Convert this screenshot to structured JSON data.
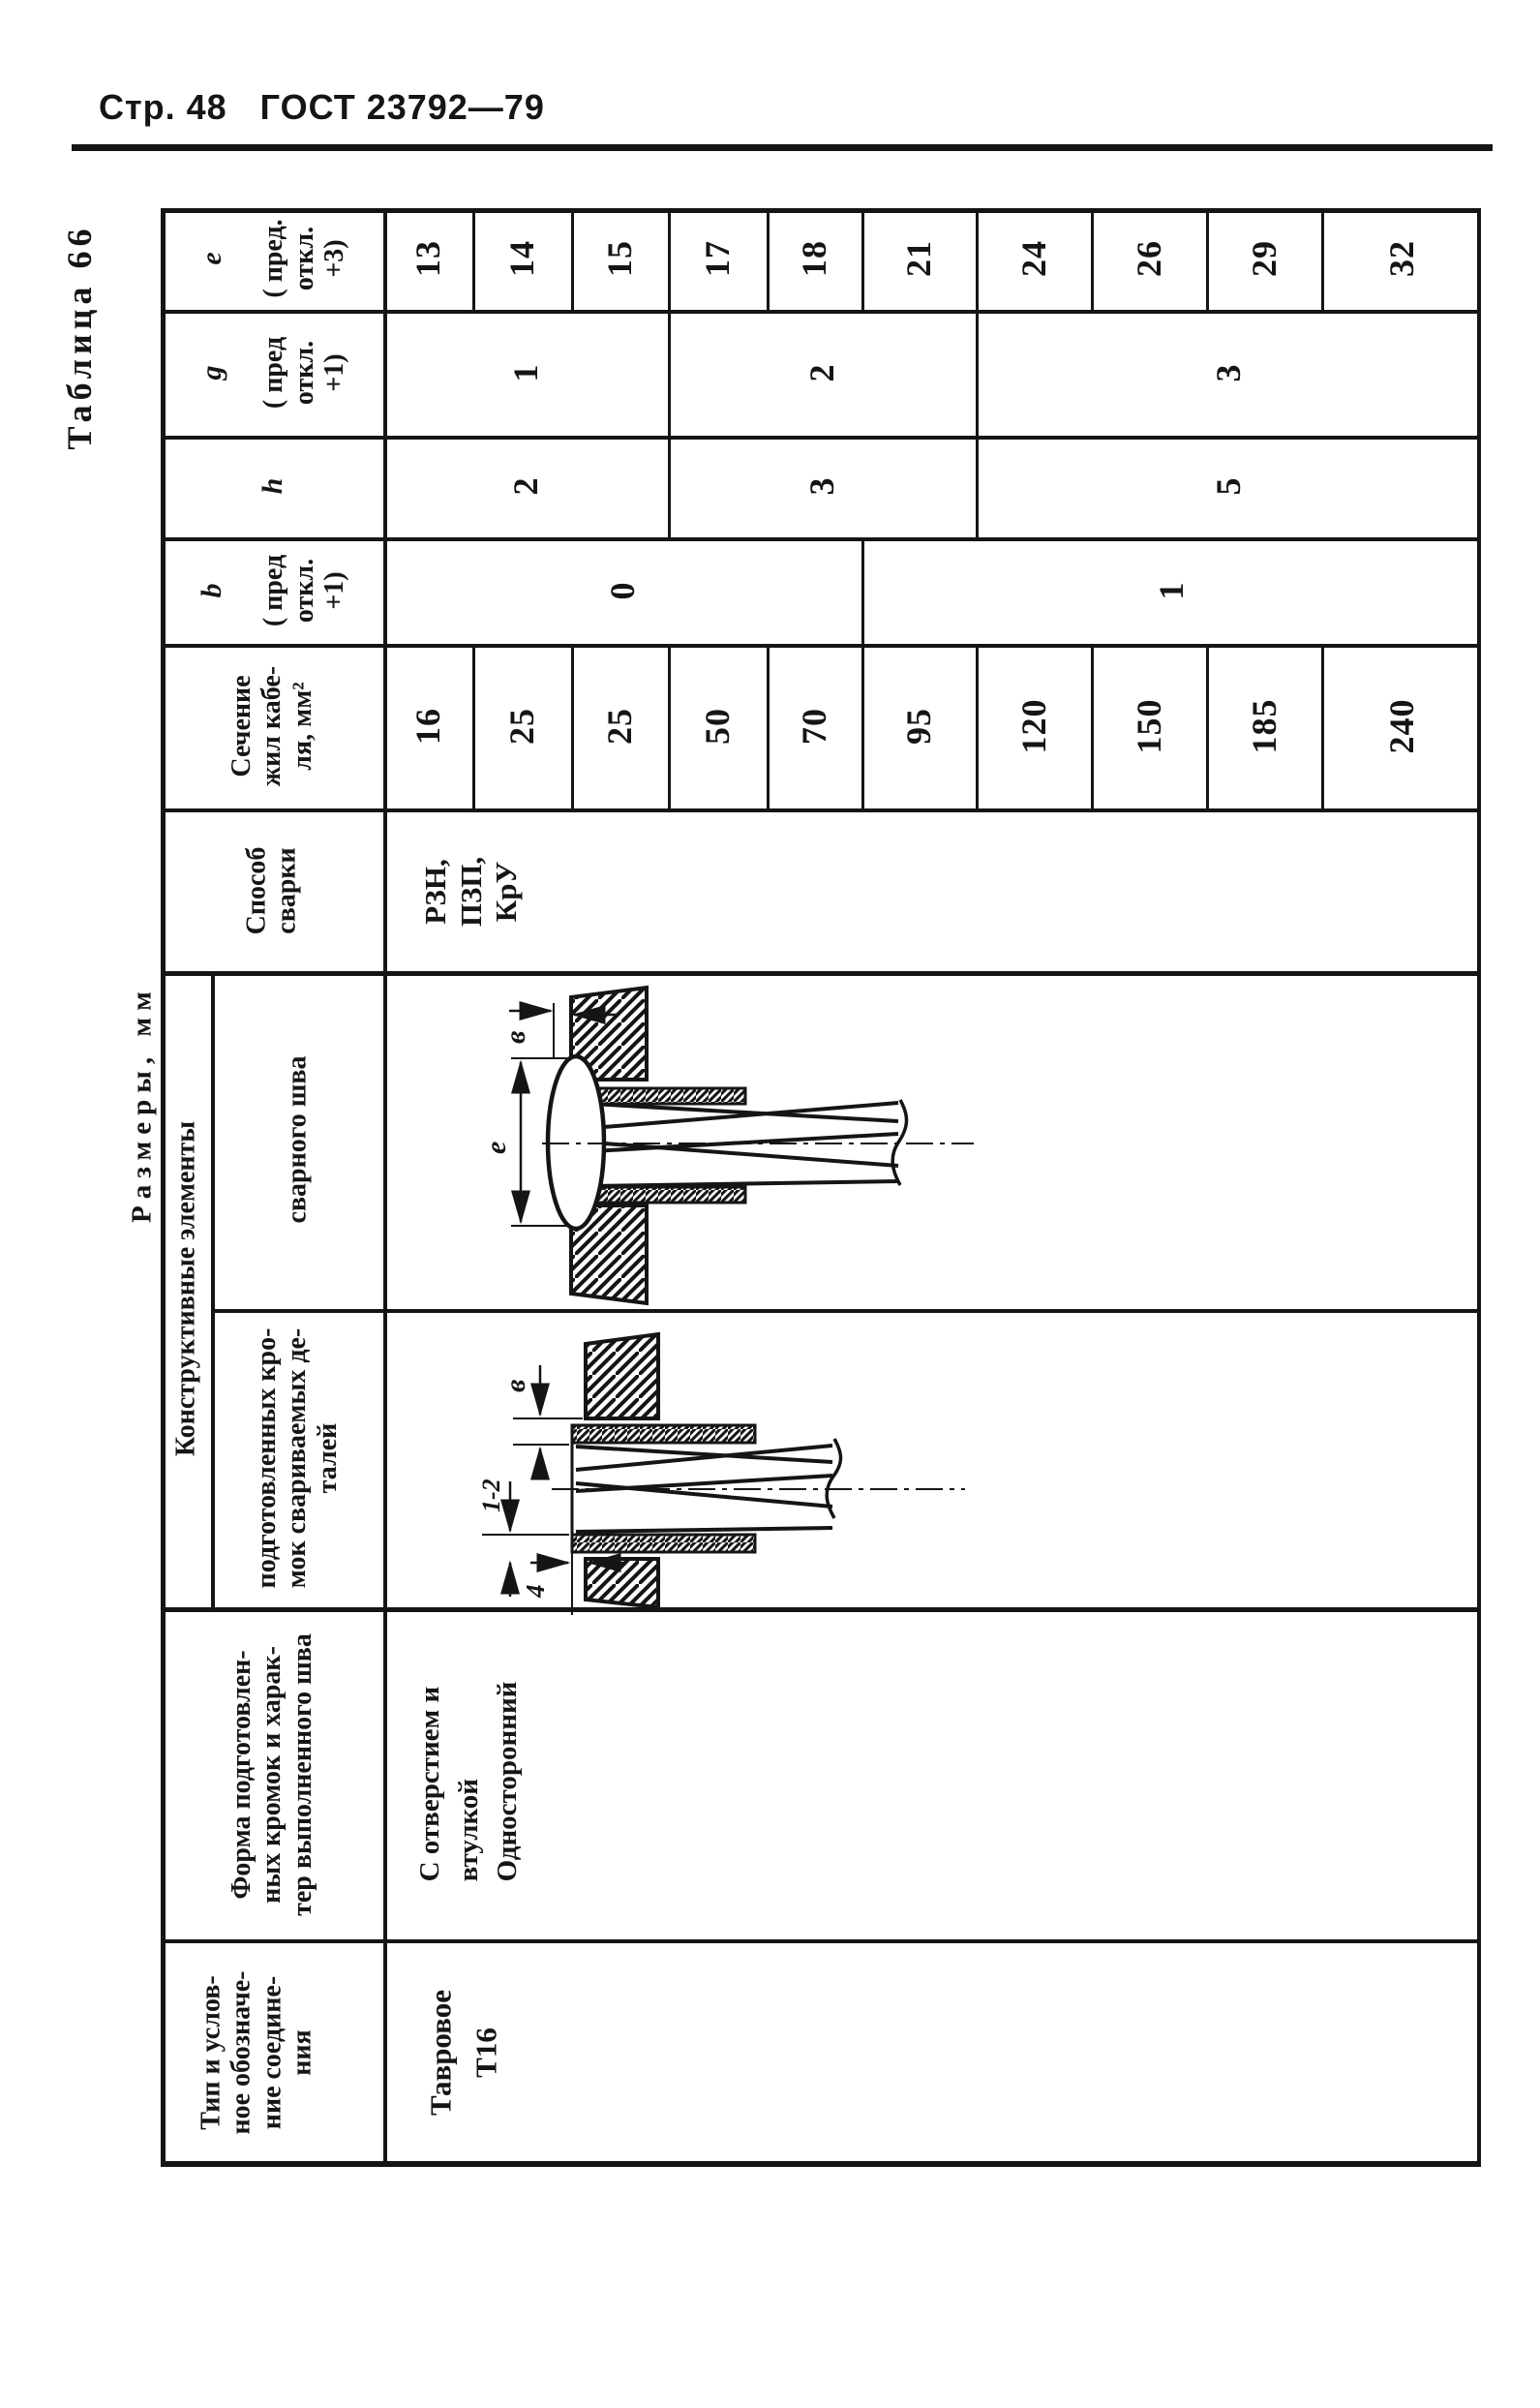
{
  "page": {
    "header_left": "Стр. 48",
    "header_right": "ГОСТ 23792—79",
    "table_caption": "Таблица 66",
    "units_note": "Размеры, мм",
    "ink_color": "#151515",
    "paper_color": "#ffffff"
  },
  "table": {
    "headers": {
      "type": [
        "Тип и услов-",
        "ное обозначе-",
        "ние соедине-",
        "ния"
      ],
      "form": [
        "Форма подготовлен-",
        "ных кромок и харак-",
        "тер выполненного шва"
      ],
      "constructive_group": "Конструктивные элементы",
      "sub_edges": [
        "подготовленных кро-",
        "мок свариваемых де-",
        "талей"
      ],
      "sub_weld": "сварного шва",
      "method": [
        "Способ",
        "сварки"
      ],
      "section": [
        "Сечение",
        "жил кабе-",
        "ля, мм²"
      ],
      "b_letter": "b",
      "b_tol": [
        "( пред",
        "откл.",
        "+1)"
      ],
      "h_letter": "h",
      "g_letter": "g",
      "g_tol": [
        "( пред",
        "откл.",
        "+1)"
      ],
      "e_letter": "е",
      "e_tol": [
        "( пред.",
        "откл.",
        "+3)"
      ]
    },
    "values": {
      "type": [
        "Тавровое",
        "Т16"
      ],
      "form": [
        "С отверстием и",
        "втулкой",
        "Односторонний"
      ],
      "method": [
        "РЗН,",
        "ПЗП,",
        "КрУ"
      ],
      "section": [
        "16",
        "25",
        "25",
        "50",
        "70",
        "95",
        "120",
        "150",
        "185",
        "240"
      ],
      "e": [
        "13",
        "14",
        "15",
        "17",
        "18",
        "21",
        "24",
        "26",
        "29",
        "32"
      ],
      "b_groups": [
        {
          "value": "0",
          "from_row": 0,
          "to_row": 4
        },
        {
          "value": "1",
          "from_row": 5,
          "to_row": 9
        }
      ],
      "h_groups": [
        {
          "value": "2",
          "from_row": 0,
          "to_row": 2
        },
        {
          "value": "3",
          "from_row": 3,
          "to_row": 5
        },
        {
          "value": "5",
          "from_row": 6,
          "to_row": 9
        }
      ],
      "g_groups": [
        {
          "value": "1",
          "from_row": 0,
          "to_row": 2
        },
        {
          "value": "2",
          "from_row": 3,
          "to_row": 5
        },
        {
          "value": "3",
          "from_row": 6,
          "to_row": 9
        }
      ]
    },
    "diagrams": {
      "weld_labels": {
        "b": "в",
        "e": "е"
      },
      "edges_labels": {
        "b": "в",
        "gap": "1-2",
        "protrusion": "4"
      }
    }
  }
}
